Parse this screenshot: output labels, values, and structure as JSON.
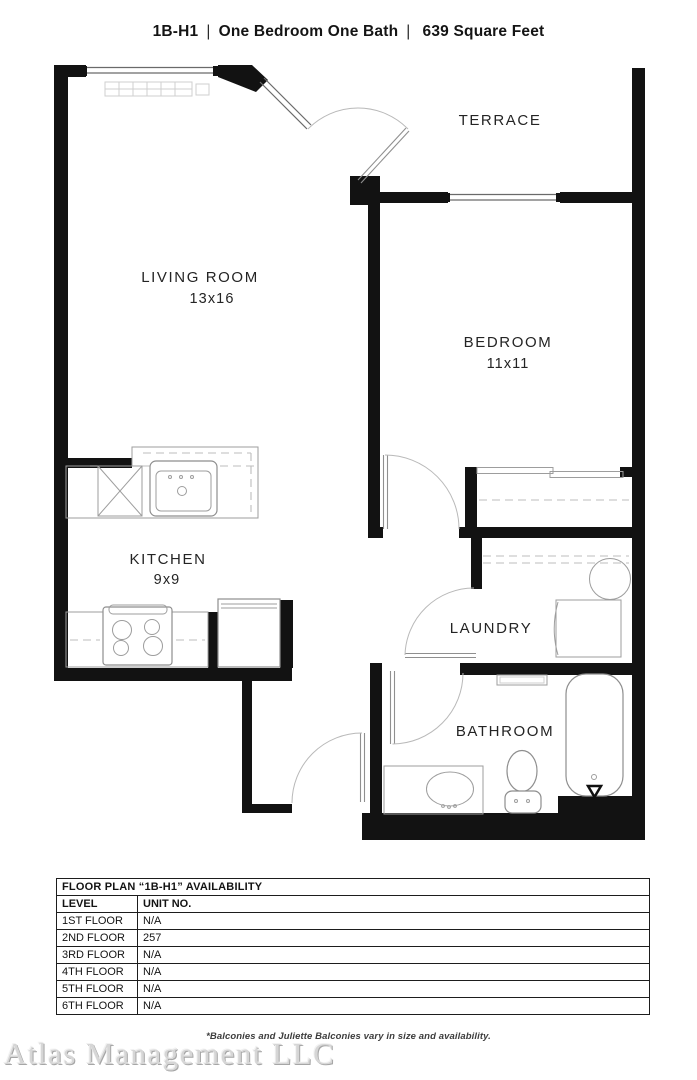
{
  "header": {
    "plan_code": "1B-H1",
    "separator": "|",
    "type": "One Bedroom One Bath",
    "area": "639 Square Feet"
  },
  "floor_plan": {
    "rooms": [
      {
        "name": "LIVING ROOM",
        "dimensions": "13x16"
      },
      {
        "name": "TERRACE",
        "dimensions": ""
      },
      {
        "name": "BEDROOM",
        "dimensions": "11x11"
      },
      {
        "name": "KITCHEN",
        "dimensions": "9x9"
      },
      {
        "name": "LAUNDRY",
        "dimensions": ""
      },
      {
        "name": "BATHROOM",
        "dimensions": ""
      }
    ],
    "fixtures": [
      "window",
      "terrace-door",
      "bedroom-door",
      "closet-sliding-doors",
      "laundry-door",
      "bathroom-door",
      "entry-door",
      "kitchen-sink",
      "dishwasher",
      "range",
      "refrigerator",
      "washer",
      "dryer",
      "bathtub",
      "toilet",
      "vanity-sink",
      "baseboard-heater"
    ]
  },
  "availability_table": {
    "title": "FLOOR PLAN “1B-H1” AVAILABILITY",
    "columns": [
      "LEVEL",
      "UNIT NO."
    ],
    "rows": [
      {
        "level": "1ST FLOOR",
        "unit": "N/A"
      },
      {
        "level": "2ND FLOOR",
        "unit": "257"
      },
      {
        "level": "3RD FLOOR",
        "unit": "N/A"
      },
      {
        "level": "4TH FLOOR",
        "unit": "N/A"
      },
      {
        "level": "5TH FLOOR",
        "unit": "N/A"
      },
      {
        "level": "6TH FLOOR",
        "unit": "N/A"
      }
    ]
  },
  "footnote": "*Balconies and Juliette Balconies vary in size and availability.",
  "watermark": "Atlas Management LLC"
}
